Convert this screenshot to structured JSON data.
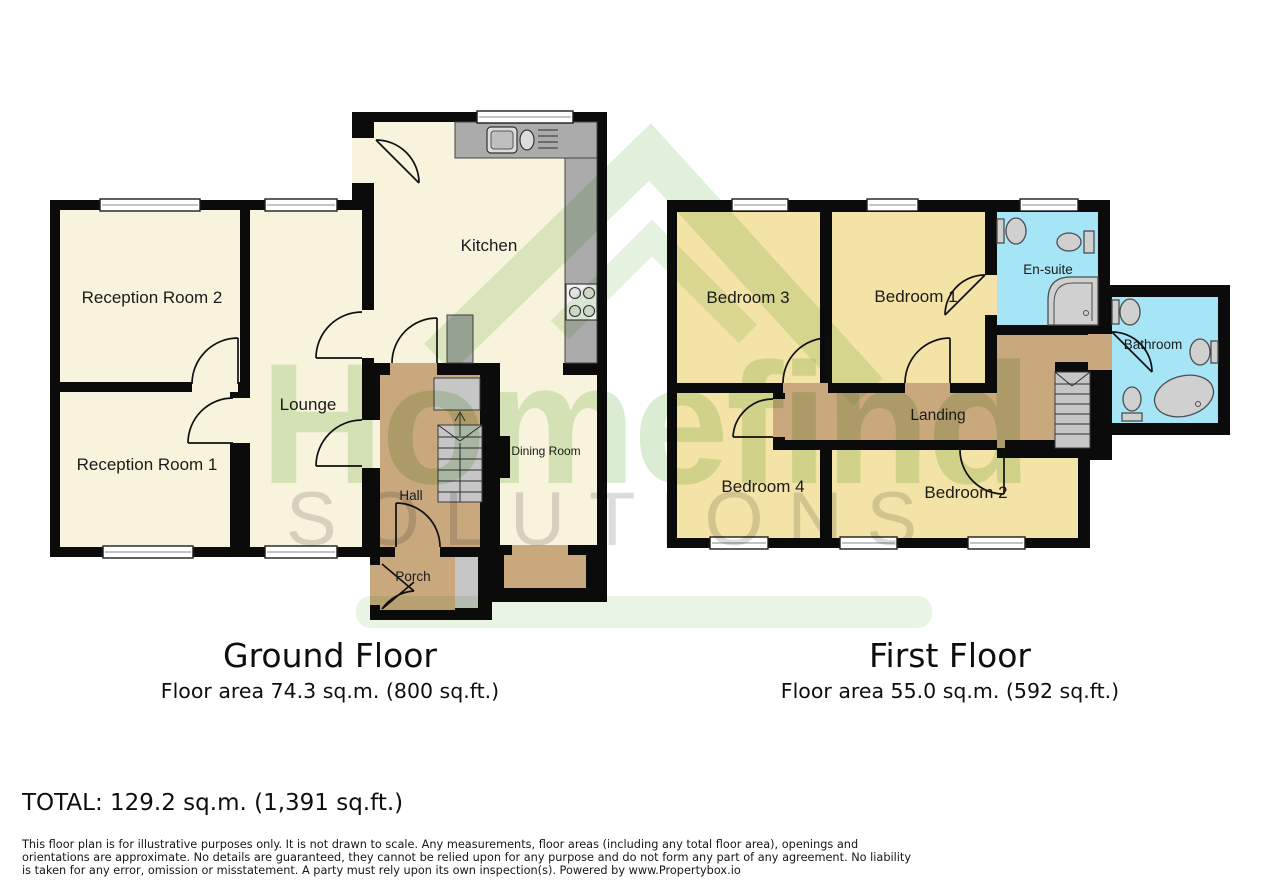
{
  "watermark": {
    "brand": "Homefind",
    "brand_sub": "SOLUTIONS"
  },
  "ground_floor": {
    "title": "Ground Floor",
    "area_label": "Floor area 74.3 sq.m. (800 sq.ft.)",
    "rooms": {
      "reception2": "Reception Room 2",
      "reception1": "Reception Room 1",
      "lounge": "Lounge",
      "kitchen": "Kitchen",
      "dining": "Dining Room",
      "hall": "Hall",
      "porch": "Porch"
    }
  },
  "first_floor": {
    "title": "First Floor",
    "area_label": "Floor area 55.0 sq.m. (592 sq.ft.)",
    "rooms": {
      "bedroom3": "Bedroom 3",
      "bedroom1": "Bedroom 1",
      "ensuite": "En-suite",
      "bathroom": "Bathroom",
      "landing": "Landing",
      "bedroom4": "Bedroom 4",
      "bedroom2": "Bedroom 2"
    }
  },
  "total_line": "TOTAL: 129.2 sq.m. (1,391 sq.ft.)",
  "disclaimer": "This floor plan is for illustrative purposes only. It is not drawn to scale. Any measurements, floor areas (including any total floor area), openings and orientations are approximate. No details are guaranteed, they cannot be relied upon for any purpose and do not form any part of any agreement. No liability is taken for any error, omission or misstatement. A party must rely upon its own inspection(s). Powered by www.Propertybox.io",
  "colors": {
    "wall": "#0b0b0b",
    "room_cream": "#f8f3dc",
    "room_yellow": "#f3e3a6",
    "hall_tan": "#c9a87e",
    "bath_cyan": "#a5e5f5",
    "counter_gray": "#ababab",
    "stair_gray": "#c6c6c6",
    "fixture_gray": "#d0d0d0"
  }
}
